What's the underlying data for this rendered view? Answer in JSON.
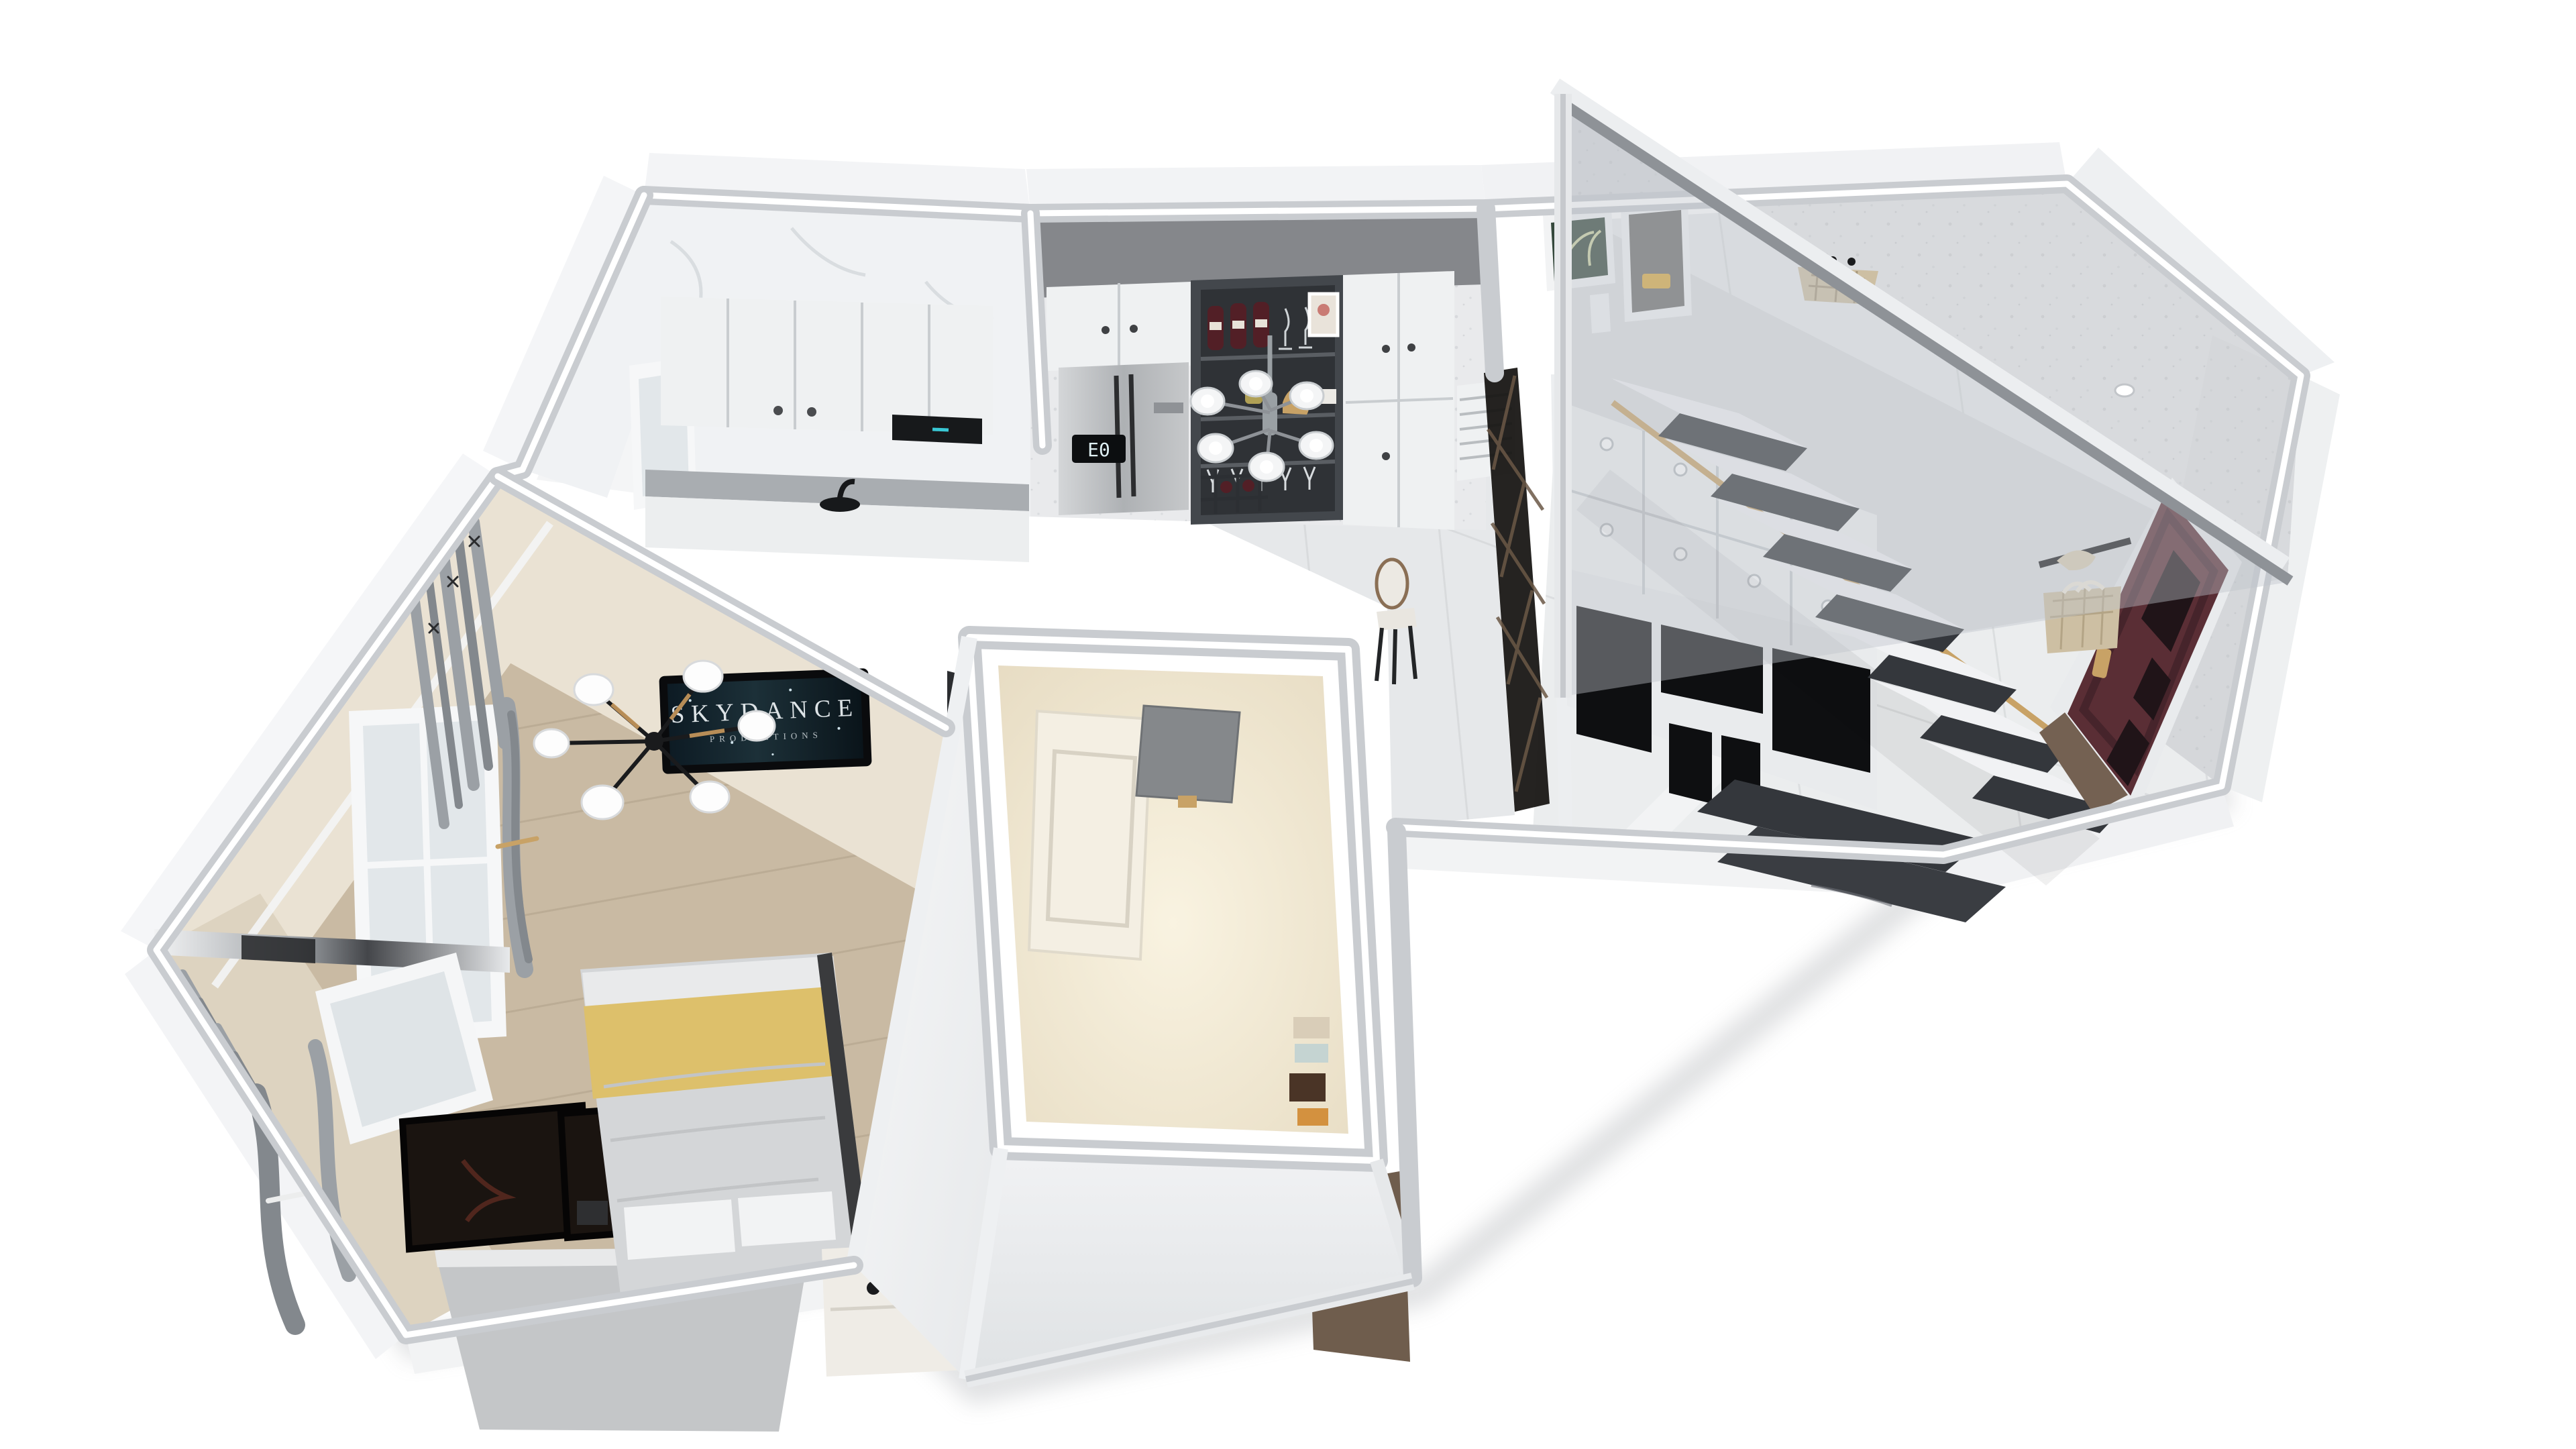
{
  "meta": {
    "title": "3D isometric dollhouse render of a small duplex apartment floor plan",
    "background": "#ffffff"
  },
  "tv": {
    "line1": "SKYDANCE",
    "line2": "PRODUCTIONS"
  },
  "fridge": {
    "display": "E0"
  },
  "colors": {
    "background": "#ffffff",
    "wallBand": "#c9ccd0",
    "wallpaper": "#eae2d3",
    "wallpaperDark": "#ddd3c0",
    "bathWall": "#f2e9d6",
    "marbleWall": "#f0f2f4",
    "speckleWall": "#e9eaec",
    "speckleGray": "#d5d7da",
    "loftWall": "#d8dadd",
    "woodFloor": "#c9baa3",
    "woodFloorLine": "#b3a48c",
    "woodDark": "#6f5d4d",
    "tileFloor": "#e6e8ea",
    "hallFloor": "#ebedee",
    "curtain": "#9ba0a5",
    "curtainDark": "#83888d",
    "blanket": "#ddc06b",
    "duvet": "#d4d6d8",
    "pillow": "#f2f3f4",
    "headboard": "#c4c6c8",
    "frameArt": "#1a1410",
    "tvFrame": "#0a0b0d",
    "tvScreen": "#15232c",
    "tvText": "#dde3e6",
    "chandelier": "#1a1b1d",
    "chandelierWood": "#c89a5e",
    "nightstand": "#efece6",
    "cabinet": "#eff1f2",
    "cabinetSeam": "#c9cdd0",
    "counter": "#a9adb1",
    "hood": "#17191b",
    "soffit": "#85878b",
    "fridgeSilver": "#c6c8ca",
    "fridgeDisplay": "#0c0e10",
    "fridgeDigits": "#dff0f4",
    "wineCabinet": "#43474c",
    "wineShelf": "#2f3236",
    "bottle": "#521f26",
    "gold": "#c8a266",
    "blackGlass": "#0e0f11",
    "stairMarble": "#34373c",
    "riser": "#f1f2f4",
    "glass": "#bec4ca",
    "handrail": "#8e9297",
    "railCap": "#eceef0",
    "doorBrown": "#5a2e35",
    "doorPanel": "#46242b",
    "doorFrame": "#e9ebed",
    "bag": "#cdbfa3",
    "shadow": "#a6a9ad"
  },
  "rooms": {
    "bedroom": {
      "label": "bedroom / living area",
      "objects": [
        "wall tv",
        "black chandelier with white disc shades",
        "gray curtains",
        "tall window",
        "mirror strip",
        "double bed",
        "yellow throw blanket",
        "gray duvet",
        "white pillows",
        "houndstooth cushions",
        "gray upholstered headboard",
        "two black framed artworks",
        "white nightstand",
        "table lamp",
        "books",
        "wood plank floor"
      ]
    },
    "kitchen": {
      "label": "kitchen",
      "objects": [
        "white marble tiled walls",
        "white upper cabinets",
        "black range hood",
        "black faucet and sink",
        "white counter",
        "window"
      ]
    },
    "dining": {
      "label": "dining room",
      "objects": [
        "gray soffit",
        "white cabinets with knobs",
        "double-door fridge with E0 display",
        "dark wine display cabinet",
        "wine bottles",
        "hanging stemware",
        "wine lattice rack",
        "picture frame",
        "six-shade pendant lamp",
        "dining chair",
        "white ac vent",
        "dark diamond-lattice glass partition"
      ]
    },
    "bathroom": {
      "label": "enclosed bathroom cube",
      "objects": [
        "beige textured walls",
        "white paneled door",
        "gray wall heater",
        "towel shelf"
      ]
    },
    "hallway": {
      "label": "entry hall with staircase",
      "objects": [
        "white storage cabinets with round knobs",
        "black glass wardrobe panels",
        "dark marble stair treads",
        "white risers",
        "glass balustrade",
        "gray handrail",
        "gold stair trim",
        "framed palm artwork",
        "framed van artwork",
        "woven wall basket",
        "entry door dark walnut",
        "gold door handle",
        "coat rack with beige bag",
        "marble tile floor",
        "dark wood floor wedge"
      ]
    }
  }
}
